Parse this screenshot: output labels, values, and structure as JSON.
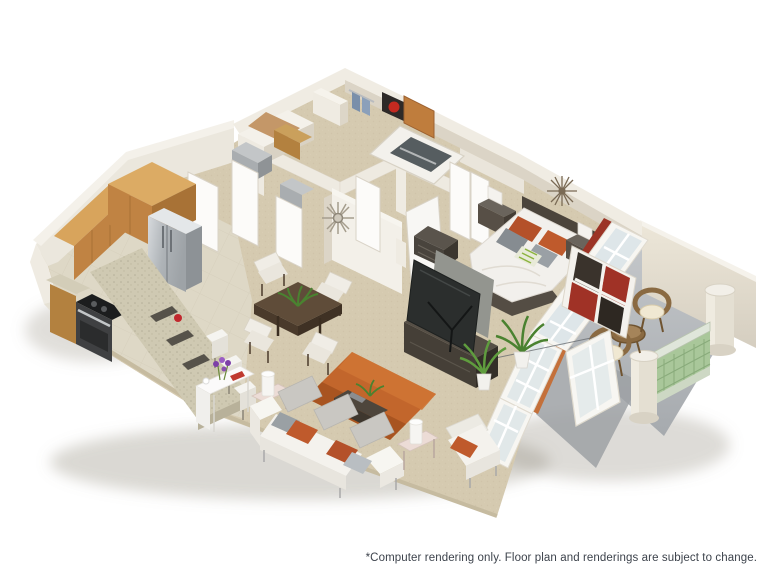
{
  "image": {
    "title": "3D floor plan rendering",
    "description": "Isometric computer rendering of a one-bedroom apartment with kitchen, dining area, living room, bedroom, bathroom and private patio"
  },
  "footer": {
    "disclaimer": "*Computer rendering only. Floor plan and renderings are subject to change."
  },
  "colors": {
    "background": "#ffffff",
    "carpet": "#d5cab0",
    "tile": "#ded8c6",
    "wall": "#efebe2",
    "wall_shade": "#d9d2c4",
    "cabinet_wood": "#c08343",
    "granite": "#cfc9b2",
    "stainless": "#b9bec2",
    "rug_orange": "#c2662c",
    "accent_orange": "#bf5a2c",
    "sofa_white": "#f4f2ed",
    "bed_duvet": "#f2f0ec",
    "dark_furniture": "#4b443b",
    "tv_screen": "#2b2e2d",
    "plant_green": "#5f9c3e",
    "patio_concrete": "#b6b9bd",
    "railing_green": "#a9c79a",
    "curtain_red": "#9c3426",
    "entry_door_wood": "#bf7d3d",
    "glass": "#d7e2e6",
    "disclaimer_text": "#3d434c"
  },
  "rooms": {
    "kitchen": {
      "items": [
        "wood cabinets",
        "stainless steel refrigerator",
        "range with cooktop",
        "granite breakfast bar",
        "three white bar stools",
        "red apple",
        "white accent table with purple flowers"
      ]
    },
    "dining_area": {
      "items": [
        "square dark wood table",
        "four upholstered chairs",
        "green plant centerpiece"
      ]
    },
    "living_room": {
      "items": [
        "white sofa with orange and gray pillows",
        "orange area rug",
        "sofa console table",
        "two side tables with white lamps",
        "white armchair with orange pillow",
        "flat screen TV on dark media console",
        "potted plants"
      ]
    },
    "bedroom": {
      "items": [
        "platform bed with white duvet",
        "dark headboard",
        "orange gray and green accent pillows",
        "two nightstands with lamps",
        "dresser",
        "starburst wall clock",
        "bookcase with red backing"
      ]
    },
    "bathroom": {
      "items": [
        "bathtub",
        "towel rack with blue towels",
        "red wall panel"
      ]
    },
    "entry_hall": {
      "items": [
        "wood entry door",
        "white interior doors",
        "closets with shelving",
        "sunburst wall mirror"
      ]
    },
    "patio": {
      "items": [
        "two wicker chairs with cream cushions",
        "wicker side table",
        "green lattice railing",
        "white columns"
      ]
    }
  }
}
